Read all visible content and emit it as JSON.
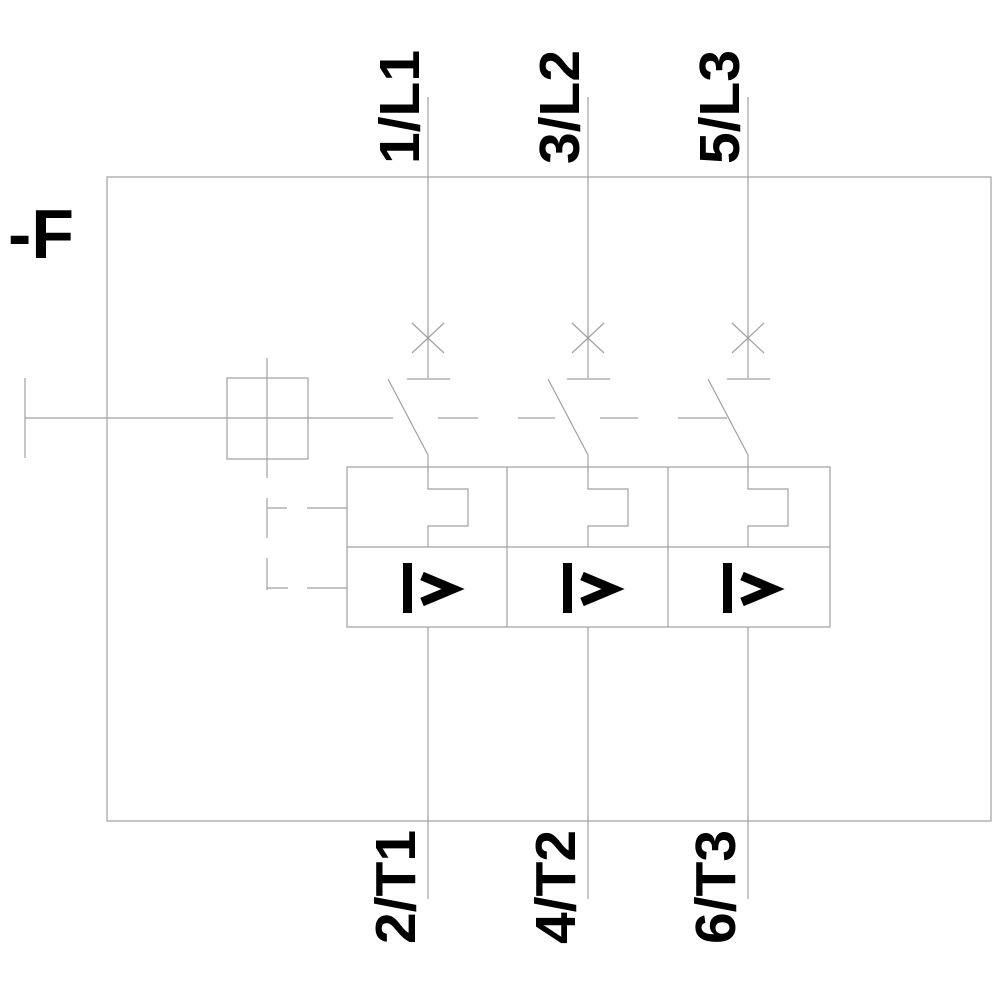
{
  "schematic": {
    "description": "3-pole motor protection circuit breaker symbol",
    "device_tag": "-F",
    "poles": [
      {
        "top_terminal": "1/L1",
        "bottom_terminal": "2/T1",
        "trip_symbol": "I>"
      },
      {
        "top_terminal": "3/L2",
        "bottom_terminal": "4/T2",
        "trip_symbol": "I>"
      },
      {
        "top_terminal": "5/L3",
        "bottom_terminal": "6/T3",
        "trip_symbol": "I>"
      }
    ],
    "colors": {
      "line": "#a0a0a0",
      "text": "#000000",
      "background": "#ffffff"
    }
  }
}
